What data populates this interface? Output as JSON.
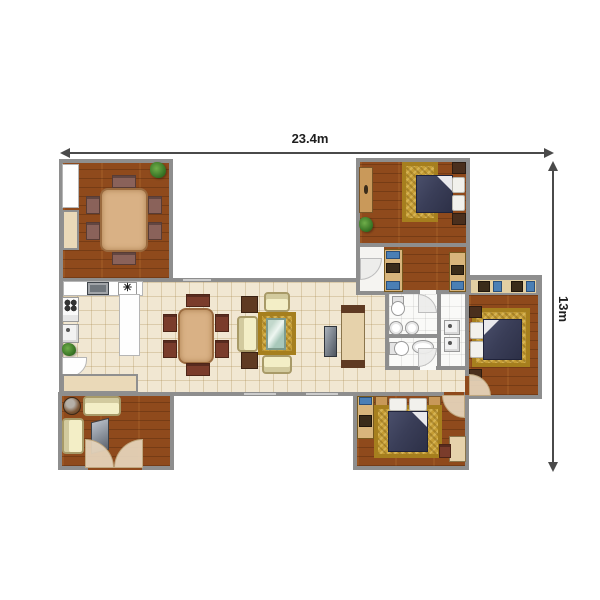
{
  "dimensions": {
    "width_label": "23.4m",
    "height_label": "13m"
  },
  "colors": {
    "wall": "#8e8e8e",
    "wood": "#8f4a1c",
    "tile": "#f1e7d2",
    "gold": "#c59d35",
    "navy": "#3a3e58",
    "cream": "#f3eec6"
  },
  "plan": {
    "items": [
      {
        "n": "main-living-band",
        "t": "room",
        "floor": "tile",
        "x": 59,
        "y": 278,
        "w": 412,
        "h": 118
      },
      {
        "n": "dining-room",
        "t": "room",
        "floor": "wood",
        "x": 59,
        "y": 159,
        "w": 114,
        "h": 123
      },
      {
        "n": "top-right-bedroom-wing",
        "t": "room",
        "floor": "wood",
        "x": 356,
        "y": 158,
        "w": 114,
        "h": 137
      },
      {
        "n": "bathroom-block",
        "t": "room",
        "floor": "white",
        "x": 385,
        "y": 290,
        "w": 84,
        "h": 80
      },
      {
        "n": "right-bedroom-wing",
        "t": "room",
        "floor": "wood",
        "x": 465,
        "y": 275,
        "w": 77,
        "h": 124
      },
      {
        "n": "bottom-right-bedroom-wing",
        "t": "room",
        "floor": "wood",
        "x": 353,
        "y": 392,
        "w": 116,
        "h": 78
      },
      {
        "n": "lounge-wing",
        "t": "room",
        "floor": "wood",
        "x": 58,
        "y": 392,
        "w": 116,
        "h": 78
      },
      {
        "n": "bedroom-divider-wall",
        "t": "wall",
        "x": 356,
        "y": 243,
        "w": 114,
        "h": 4
      },
      {
        "n": "bath-divider-vertical",
        "t": "wall",
        "x": 437,
        "y": 290,
        "w": 4,
        "h": 80
      },
      {
        "n": "bath-divider-horizontal",
        "t": "wall",
        "x": 385,
        "y": 334,
        "w": 56,
        "h": 4
      },
      {
        "n": "door-gap-lounge",
        "t": "gap",
        "cls": "wood",
        "x": 88,
        "y": 464,
        "w": 54,
        "h": 6
      },
      {
        "n": "door-gap-bath-upper",
        "t": "gap",
        "cls": "white",
        "x": 420,
        "y": 290,
        "w": 16,
        "h": 4
      },
      {
        "n": "door-gap-bath-lower",
        "t": "gap",
        "cls": "white",
        "x": 420,
        "y": 366,
        "w": 16,
        "h": 4
      },
      {
        "n": "door-gap-right-bedroom",
        "t": "gap",
        "cls": "wood",
        "x": 465,
        "y": 376,
        "w": 4,
        "h": 19
      },
      {
        "n": "door-gap-bottom-bedroom",
        "t": "gap",
        "cls": "wood",
        "x": 444,
        "y": 392,
        "w": 20,
        "h": 4
      },
      {
        "n": "window-top-wall",
        "t": "window",
        "x": 182,
        "y": 278,
        "w": 30,
        "h": 4
      },
      {
        "n": "window-bottom-wall-1",
        "t": "window",
        "x": 243,
        "y": 392,
        "w": 34,
        "h": 4
      },
      {
        "n": "window-bottom-wall-2",
        "t": "window",
        "x": 305,
        "y": 392,
        "w": 34,
        "h": 4
      },
      {
        "n": "dining-wall-counter",
        "t": "counter",
        "x": 62,
        "y": 164,
        "w": 17,
        "h": 44
      },
      {
        "n": "dining-wall-cabinet",
        "t": "wardrobe",
        "x": 62,
        "y": 210,
        "w": 17,
        "h": 40
      },
      {
        "n": "dining-plant",
        "t": "plant",
        "x": 150,
        "y": 162,
        "w": 16,
        "h": 16
      },
      {
        "n": "dining-table",
        "t": "table",
        "x": 100,
        "y": 188,
        "w": 48,
        "h": 64
      },
      {
        "n": "dining-chair",
        "t": "chair",
        "cls": "mauve",
        "x": 86,
        "y": 196,
        "w": 14,
        "h": 18
      },
      {
        "n": "dining-chair",
        "t": "chair",
        "cls": "mauve",
        "x": 86,
        "y": 222,
        "w": 14,
        "h": 18
      },
      {
        "n": "dining-chair",
        "t": "chair",
        "cls": "mauve",
        "x": 148,
        "y": 196,
        "w": 14,
        "h": 18
      },
      {
        "n": "dining-chair",
        "t": "chair",
        "cls": "mauve",
        "x": 148,
        "y": 222,
        "w": 14,
        "h": 18
      },
      {
        "n": "dining-chair",
        "t": "chair",
        "cls": "mauve",
        "x": 112,
        "y": 175,
        "w": 24,
        "h": 13
      },
      {
        "n": "dining-chair",
        "t": "chair",
        "cls": "mauve",
        "x": 112,
        "y": 252,
        "w": 24,
        "h": 13
      },
      {
        "n": "kitchen-counter",
        "t": "counter",
        "x": 63,
        "y": 281,
        "w": 80,
        "h": 15
      },
      {
        "n": "kitchen-sink",
        "t": "ksink",
        "x": 87,
        "y": 282,
        "w": 22,
        "h": 13
      },
      {
        "n": "cooktop-symbol",
        "t": "hob",
        "x": 118,
        "y": 282,
        "w": 19,
        "h": 13,
        "glyph": "✳"
      },
      {
        "n": "stove",
        "t": "stove",
        "x": 62,
        "y": 297,
        "w": 17,
        "h": 25
      },
      {
        "n": "dishwasher",
        "t": "appliance",
        "x": 62,
        "y": 324,
        "w": 17,
        "h": 19
      },
      {
        "n": "kitchen-plant",
        "t": "plant",
        "x": 62,
        "y": 343,
        "w": 14,
        "h": 13
      },
      {
        "n": "kitchen-corner-counter",
        "t": "counter",
        "cls": "curve",
        "x": 62,
        "y": 357,
        "w": 25,
        "h": 21
      },
      {
        "n": "kitchen-island",
        "t": "counter",
        "x": 119,
        "y": 294,
        "w": 21,
        "h": 62
      },
      {
        "n": "family-table",
        "t": "table",
        "x": 178,
        "y": 308,
        "w": 36,
        "h": 56
      },
      {
        "n": "family-chair",
        "t": "chair",
        "x": 163,
        "y": 314,
        "w": 14,
        "h": 18
      },
      {
        "n": "family-chair",
        "t": "chair",
        "x": 163,
        "y": 340,
        "w": 14,
        "h": 18
      },
      {
        "n": "family-chair",
        "t": "chair",
        "x": 215,
        "y": 314,
        "w": 14,
        "h": 18
      },
      {
        "n": "family-chair",
        "t": "chair",
        "x": 215,
        "y": 340,
        "w": 14,
        "h": 18
      },
      {
        "n": "family-chair",
        "t": "chair",
        "x": 186,
        "y": 294,
        "w": 24,
        "h": 13
      },
      {
        "n": "family-chair",
        "t": "chair",
        "x": 186,
        "y": 363,
        "w": 24,
        "h": 13
      },
      {
        "n": "side-table",
        "t": "sidetable",
        "x": 241,
        "y": 296,
        "w": 17,
        "h": 17
      },
      {
        "n": "side-table",
        "t": "sidetable",
        "x": 241,
        "y": 352,
        "w": 17,
        "h": 17
      },
      {
        "n": "living-sofa",
        "t": "sofa",
        "cls": "back-l",
        "x": 237,
        "y": 316,
        "w": 21,
        "h": 36
      },
      {
        "n": "living-armchair",
        "t": "sofa",
        "cls": "back-t",
        "x": 264,
        "y": 292,
        "w": 26,
        "h": 20
      },
      {
        "n": "living-sofa",
        "t": "sofa",
        "cls": "back-b",
        "x": 262,
        "y": 355,
        "w": 30,
        "h": 19
      },
      {
        "n": "living-rug",
        "t": "rug",
        "x": 258,
        "y": 312,
        "w": 38,
        "h": 43
      },
      {
        "n": "coffee-table",
        "t": "glass",
        "x": 266,
        "y": 318,
        "w": 20,
        "h": 32
      },
      {
        "n": "tv-stand",
        "t": "tv",
        "x": 324,
        "y": 326,
        "w": 13,
        "h": 31
      },
      {
        "n": "sideboard",
        "t": "sideboard",
        "x": 341,
        "y": 305,
        "w": 24,
        "h": 63
      },
      {
        "n": "hall-closet",
        "t": "wardrobe",
        "x": 62,
        "y": 374,
        "w": 76,
        "h": 19
      },
      {
        "n": "bedroom1-dresser",
        "t": "dresser",
        "x": 359,
        "y": 167,
        "w": 14,
        "h": 46
      },
      {
        "n": "bedroom1-plant",
        "t": "plant",
        "x": 359,
        "y": 217,
        "w": 14,
        "h": 15
      },
      {
        "n": "bedroom1-rug",
        "t": "rug",
        "x": 402,
        "y": 162,
        "w": 36,
        "h": 60
      },
      {
        "n": "bedroom1-bed",
        "t": "bed",
        "cls": "fold-r",
        "x": 416,
        "y": 175,
        "w": 37,
        "h": 38
      },
      {
        "n": "bedroom1-pillow",
        "t": "pillow",
        "x": 452,
        "y": 177,
        "w": 13,
        "h": 16
      },
      {
        "n": "bedroom1-pillow",
        "t": "pillow",
        "x": 452,
        "y": 195,
        "w": 13,
        "h": 16
      },
      {
        "n": "bedroom1-nightstand",
        "t": "nightstand",
        "x": 452,
        "y": 162,
        "w": 14,
        "h": 12
      },
      {
        "n": "bedroom1-nightstand",
        "t": "nightstand",
        "x": 452,
        "y": 213,
        "w": 14,
        "h": 12
      },
      {
        "n": "vestibule-floor",
        "t": "panel",
        "x": 360,
        "y": 247,
        "w": 24,
        "h": 44
      },
      {
        "n": "vestibule-door",
        "t": "door",
        "cls": "lite c-br",
        "x": 360,
        "y": 258,
        "w": 22,
        "h": 22
      },
      {
        "n": "dressing-wardrobe",
        "t": "wardrobe2",
        "x": 384,
        "y": 249,
        "w": 19,
        "h": 43
      },
      {
        "n": "wardrobe-item",
        "t": "boxblue",
        "x": 386,
        "y": 251,
        "w": 14,
        "h": 8
      },
      {
        "n": "wardrobe-item",
        "t": "boxdark",
        "x": 386,
        "y": 263,
        "w": 14,
        "h": 10
      },
      {
        "n": "wardrobe-item",
        "t": "boxblue",
        "x": 386,
        "y": 281,
        "w": 14,
        "h": 9
      },
      {
        "n": "dressing-wardrobe",
        "t": "wardrobe2",
        "x": 449,
        "y": 252,
        "w": 17,
        "h": 40
      },
      {
        "n": "wardrobe-item",
        "t": "boxdark",
        "x": 451,
        "y": 265,
        "w": 13,
        "h": 10
      },
      {
        "n": "wardrobe-item",
        "t": "boxblue",
        "x": 451,
        "y": 281,
        "w": 13,
        "h": 9
      },
      {
        "n": "toilet-upper",
        "t": "toilet",
        "cls": "face-d",
        "x": 390,
        "y": 296,
        "w": 16,
        "h": 20
      },
      {
        "n": "bath-sink",
        "t": "basin",
        "x": 389,
        "y": 321,
        "w": 14,
        "h": 14
      },
      {
        "n": "bath-sink",
        "t": "basin",
        "x": 405,
        "y": 321,
        "w": 14,
        "h": 14
      },
      {
        "n": "bath-door-upper",
        "t": "door",
        "cls": "lite c-tr",
        "x": 418,
        "y": 294,
        "w": 19,
        "h": 19
      },
      {
        "n": "toilet-lower",
        "t": "toilet",
        "cls": "face-r",
        "x": 389,
        "y": 340,
        "w": 20,
        "h": 17
      },
      {
        "n": "bath-basin-oval",
        "t": "basin",
        "x": 412,
        "y": 340,
        "w": 22,
        "h": 14
      },
      {
        "n": "bath-door-lower",
        "t": "door",
        "cls": "lite c-br",
        "x": 418,
        "y": 348,
        "w": 19,
        "h": 19
      },
      {
        "n": "utility-appliance",
        "t": "appliance",
        "x": 444,
        "y": 320,
        "w": 16,
        "h": 15
      },
      {
        "n": "utility-appliance",
        "t": "appliance",
        "x": 444,
        "y": 337,
        "w": 16,
        "h": 15
      },
      {
        "n": "bedroom2-closet",
        "t": "closetstrip",
        "x": 469,
        "y": 278,
        "w": 69,
        "h": 17
      },
      {
        "n": "closet-item",
        "t": "boxdark",
        "x": 478,
        "y": 281,
        "w": 12,
        "h": 11
      },
      {
        "n": "closet-item",
        "t": "boxblue",
        "x": 493,
        "y": 281,
        "w": 9,
        "h": 11
      },
      {
        "n": "closet-item",
        "t": "boxdark",
        "x": 511,
        "y": 281,
        "w": 12,
        "h": 11
      },
      {
        "n": "closet-item",
        "t": "boxblue",
        "x": 526,
        "y": 281,
        "w": 9,
        "h": 11
      },
      {
        "n": "bedroom2-rug",
        "t": "rug",
        "x": 472,
        "y": 308,
        "w": 58,
        "h": 59
      },
      {
        "n": "bedroom2-nightstand",
        "t": "nightstand",
        "x": 469,
        "y": 306,
        "w": 13,
        "h": 12
      },
      {
        "n": "bedroom2-nightstand",
        "t": "nightstand",
        "x": 469,
        "y": 369,
        "w": 13,
        "h": 12
      },
      {
        "n": "bedroom2-pillow",
        "t": "pillow",
        "x": 470,
        "y": 322,
        "w": 14,
        "h": 17
      },
      {
        "n": "bedroom2-pillow",
        "t": "pillow",
        "x": 470,
        "y": 341,
        "w": 14,
        "h": 17
      },
      {
        "n": "bedroom2-bed",
        "t": "bed",
        "cls": "fold-l",
        "x": 483,
        "y": 319,
        "w": 39,
        "h": 41
      },
      {
        "n": "bedroom2-door",
        "t": "door",
        "cls": "c-tr",
        "x": 469,
        "y": 374,
        "w": 22,
        "h": 22
      },
      {
        "n": "bedroom3-cabinet",
        "t": "wardrobe2",
        "x": 357,
        "y": 396,
        "w": 17,
        "h": 43
      },
      {
        "n": "cabinet-item",
        "t": "boxblue",
        "x": 359,
        "y": 397,
        "w": 13,
        "h": 8
      },
      {
        "n": "cabinet-item",
        "t": "boxdark",
        "x": 359,
        "y": 415,
        "w": 13,
        "h": 12
      },
      {
        "n": "bedroom3-nightstand",
        "t": "nightstand",
        "cls": "tan",
        "x": 375,
        "y": 396,
        "w": 13,
        "h": 12
      },
      {
        "n": "bedroom3-nightstand",
        "t": "nightstand",
        "cls": "tan",
        "x": 428,
        "y": 396,
        "w": 13,
        "h": 12
      },
      {
        "n": "bedroom3-rug",
        "t": "rug",
        "x": 374,
        "y": 405,
        "w": 68,
        "h": 53
      },
      {
        "n": "bedroom3-pillow",
        "t": "pillow",
        "x": 389,
        "y": 398,
        "w": 18,
        "h": 13
      },
      {
        "n": "bedroom3-pillow",
        "t": "pillow",
        "x": 409,
        "y": 398,
        "w": 18,
        "h": 13
      },
      {
        "n": "bedroom3-bed",
        "t": "bed",
        "cls": "fold-r",
        "x": 388,
        "y": 411,
        "w": 40,
        "h": 41
      },
      {
        "n": "bedroom3-desk",
        "t": "desk",
        "x": 449,
        "y": 436,
        "w": 17,
        "h": 26
      },
      {
        "n": "bedroom3-chair",
        "t": "chair",
        "x": 439,
        "y": 444,
        "w": 12,
        "h": 14
      },
      {
        "n": "bedroom3-door",
        "t": "door",
        "cls": "c-bl",
        "x": 442,
        "y": 395,
        "w": 23,
        "h": 23
      },
      {
        "n": "lounge-round-table",
        "t": "roundtable",
        "x": 63,
        "y": 397,
        "w": 18,
        "h": 18
      },
      {
        "n": "lounge-sofa",
        "t": "sofa",
        "cls": "back-t",
        "x": 83,
        "y": 396,
        "w": 38,
        "h": 20
      },
      {
        "n": "lounge-sofa",
        "t": "sofa",
        "cls": "back-l",
        "x": 62,
        "y": 418,
        "w": 22,
        "h": 36
      },
      {
        "n": "lounge-tv",
        "t": "tvbig",
        "x": 91,
        "y": 420,
        "w": 18,
        "h": 32
      },
      {
        "n": "lounge-door",
        "t": "door",
        "cls": "c-tr",
        "x": 85,
        "y": 439,
        "w": 29,
        "h": 29
      },
      {
        "n": "lounge-door",
        "t": "door",
        "cls": "c-tl",
        "x": 114,
        "y": 439,
        "w": 29,
        "h": 29
      }
    ]
  }
}
